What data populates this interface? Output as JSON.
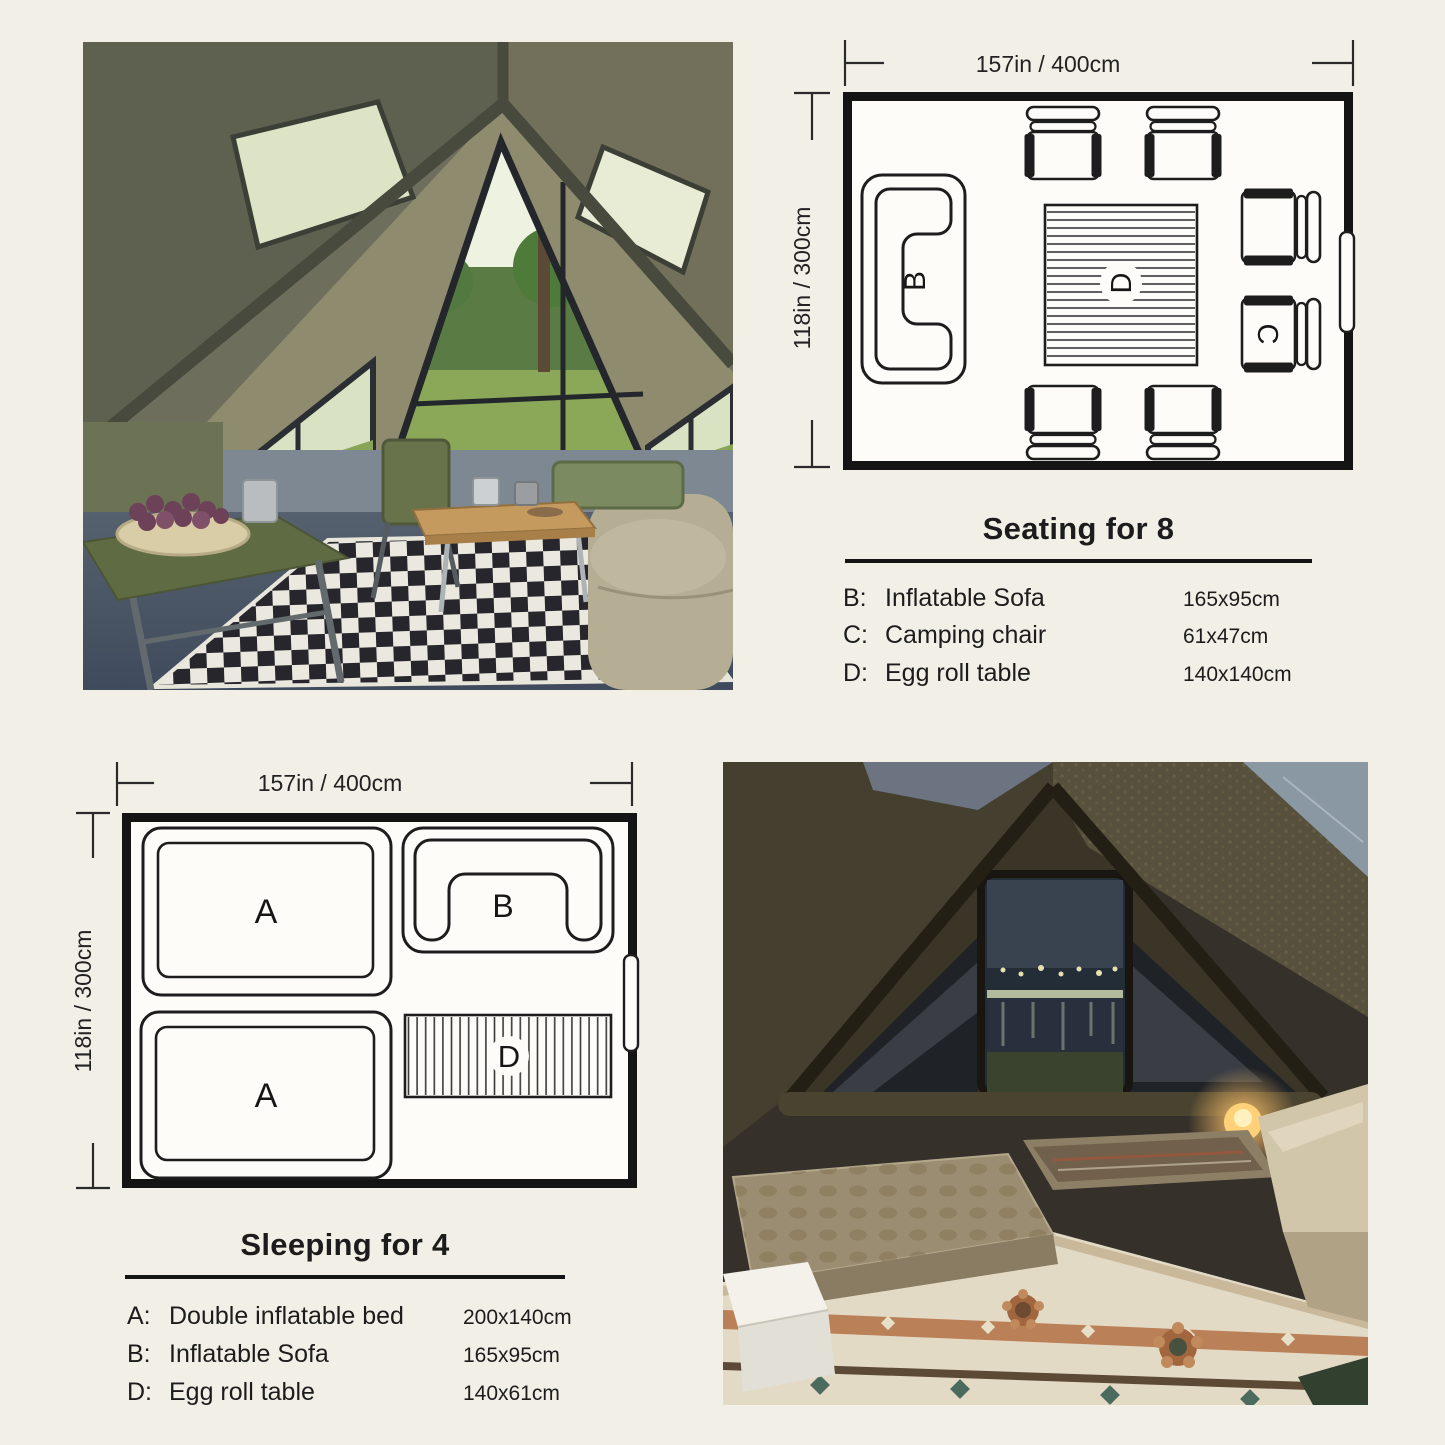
{
  "seating_plan": {
    "width_label": "157in / 400cm",
    "height_label": "118in / 300cm",
    "title": "Seating for 8",
    "items": {
      "sofa": "B",
      "table": "D",
      "chair": "C"
    },
    "legend": [
      {
        "key": "B:",
        "name": "Inflatable Sofa",
        "size": "165x95cm"
      },
      {
        "key": "C:",
        "name": "Camping chair",
        "size": "61x47cm"
      },
      {
        "key": "D:",
        "name": "Egg roll table",
        "size": "140x140cm"
      }
    ]
  },
  "sleeping_plan": {
    "width_label": "157in / 400cm",
    "height_label": "118in / 300cm",
    "title": "Sleeping for 4",
    "items": {
      "bed_top": "A",
      "bed_bottom": "A",
      "sofa": "B",
      "table": "D"
    },
    "legend": [
      {
        "key": "A:",
        "name": "Double inflatable bed",
        "size": "200x140cm"
      },
      {
        "key": "B:",
        "name": "Inflatable Sofa",
        "size": "165x95cm"
      },
      {
        "key": "D:",
        "name": "Egg roll table",
        "size": "140x61cm"
      }
    ]
  },
  "colors": {
    "background": "#f2efe7",
    "line": "#1d1d1d",
    "plan_fill": "#fdfcf8"
  }
}
